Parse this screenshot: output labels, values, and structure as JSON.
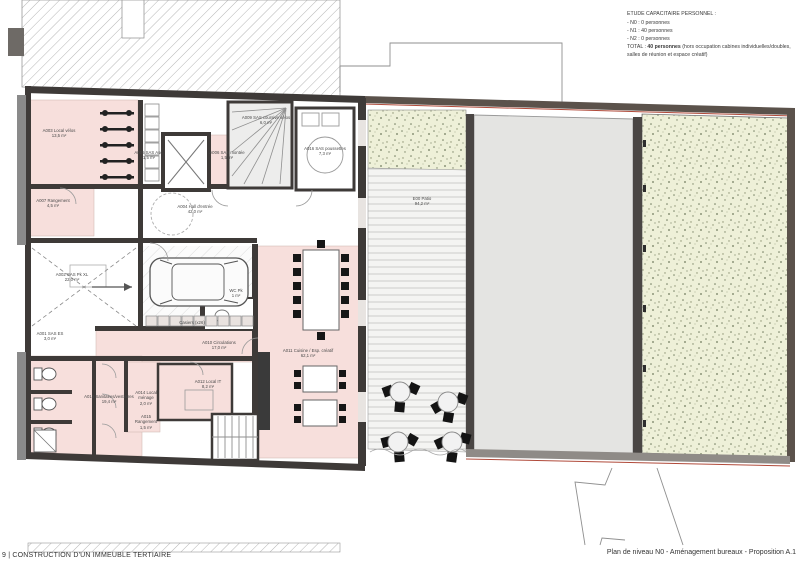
{
  "capacity_note": {
    "title": "ETUDE CAPACITAIRE PERSONNEL :",
    "lines": [
      "- N0 : 0 personnes",
      "- N1 : 40 personnes",
      "- N2 : 0 personnes"
    ],
    "total_label": "TOTAL : ",
    "total_value": "40 personnes",
    "total_note": " (hors occupation cabines individuelles/doubles, salles de réunion et espace créatif)"
  },
  "footer": {
    "left": "9 |  CONSTRUCTION D'UN IMMEUBLE TERTIAIRE",
    "right": "Plan de niveau N0 - Aménagement bureaux - Proposition A.1"
  },
  "plan": {
    "title": "Plan de niveau N0",
    "colors": {
      "room_pink": "#f7dfdc",
      "wall_dark": "#3e3a38",
      "garden_green": "#eef0d8",
      "concrete_gray": "#e4e4e2",
      "boundary_red": "#b04a3a"
    },
    "rooms": [
      {
        "id": "A003",
        "label": "A003 Local vélos",
        "area": "13,5 m²",
        "x": 32,
        "y": 128,
        "w": 54
      },
      {
        "id": "A005",
        "label": "A005 SAS Asc.",
        "area": "1,5 m²",
        "x": 134,
        "y": 150,
        "w": 30
      },
      {
        "id": "A006",
        "label": "A006 SAS montée",
        "area": "1,5 m²",
        "x": 209,
        "y": 150,
        "w": 36
      },
      {
        "id": "A009",
        "label": "A009 SAS coursive vélos",
        "area": "6,0 m²",
        "x": 238,
        "y": 115,
        "w": 56
      },
      {
        "id": "A016",
        "label": "A016 SAS poussettes",
        "area": "7,3 m²",
        "x": 301,
        "y": 146,
        "w": 48
      },
      {
        "id": "A004",
        "label": "A004 Hall d'entrée",
        "area": "42,0 m²",
        "x": 170,
        "y": 204,
        "w": 50
      },
      {
        "id": "A007",
        "label": "A007 Rangement",
        "area": "4,5 m²",
        "x": 32,
        "y": 198,
        "w": 42
      },
      {
        "id": "A002",
        "label": "A002 SAS Pk XL",
        "area": "22,0 m²",
        "x": 50,
        "y": 272,
        "w": 44
      },
      {
        "id": "WCPK",
        "label": "WC Pk",
        "area": "1 m²",
        "x": 222,
        "y": 288,
        "w": 28
      },
      {
        "id": "A001",
        "label": "A001 SAS ES",
        "area": "3,0 m²",
        "x": 32,
        "y": 331,
        "w": 36
      },
      {
        "id": "A010",
        "label": "A010 Circulations",
        "area": "17,0 m²",
        "x": 196,
        "y": 340,
        "w": 46
      },
      {
        "id": "A011",
        "label": "A011 Cuisine / Esp. créatif",
        "area": "62,1 m²",
        "x": 278,
        "y": 348,
        "w": 60
      },
      {
        "id": "A013",
        "label": "A013 Sanitaires/vestiaires",
        "area": "19,4 m²",
        "x": 80,
        "y": 394,
        "w": 58
      },
      {
        "id": "A014",
        "label": "A014 Local ménage",
        "area": "2,0 m²",
        "x": 130,
        "y": 390,
        "w": 32
      },
      {
        "id": "A015",
        "label": "A015 Rangement",
        "area": "1,5 m²",
        "x": 130,
        "y": 414,
        "w": 32
      },
      {
        "id": "A012",
        "label": "A012 Local IT",
        "area": "8,2 m²",
        "x": 188,
        "y": 379,
        "w": 40
      },
      {
        "id": "E00",
        "label": "E00 Patio",
        "area": "94,2 m²",
        "x": 404,
        "y": 196,
        "w": 36
      },
      {
        "id": "CAS",
        "label": "Casiers (x26)",
        "area": "",
        "x": 170,
        "y": 320,
        "w": 44
      }
    ]
  }
}
